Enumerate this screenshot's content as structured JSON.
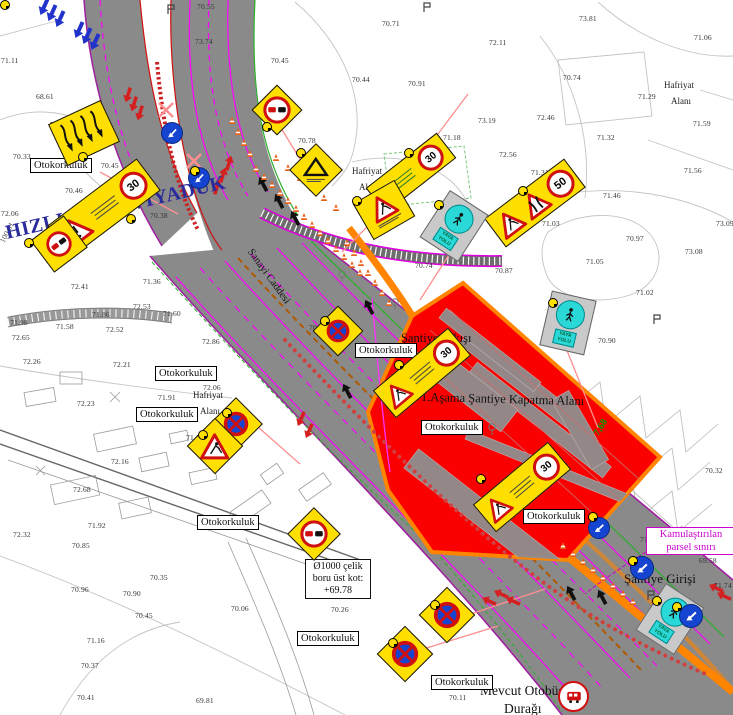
{
  "labels": {
    "hizli_tren": "HIZLI TREN VİYADÜK",
    "km": "100.01",
    "sanayi_caddesi": "Sanayi Caddesi",
    "otokorkuluk": "Otokorkuluk",
    "hafriyat": "Hafriyat",
    "alani": "Alanı",
    "santiye_cikisi": "Şantiye Çıkışı",
    "kapatma_alani": "1.Aşama Şantiye Kapatma Alanı",
    "santiye_girisi": "Şantiye Girişi",
    "kamulastirilan_l1": "Kamulaştırılan",
    "kamulastirilan_l2": "parsel sınırı",
    "mevcut_otobus_l1": "Mevcut Otobüs",
    "mevcut_otobus_l2": "Durağı",
    "boru_l1": "Ø1000 çelik",
    "boru_l2": "boru üst kot:",
    "boru_l3": "+69.78",
    "kot_768": "7,68",
    "yaya_1": "YAYA",
    "yaya_2": "YOLU"
  },
  "speeds": {
    "s30": "30",
    "s50": "50"
  },
  "colors": {
    "closure_red": "#fa0000",
    "barrier_orange": "#ff8400",
    "sign_yellow": "#ffdf00",
    "lane_magenta": "#ff00ff",
    "title_blue": "#2b2b9b",
    "parcel_magenta": "#cc00cc",
    "road_gray": "#8a8a8a"
  },
  "otokorkuluk_positions": [
    {
      "x": 30,
      "y": 158
    },
    {
      "x": 155,
      "y": 366
    },
    {
      "x": 136,
      "y": 407
    },
    {
      "x": 355,
      "y": 343
    },
    {
      "x": 421,
      "y": 420
    },
    {
      "x": 523,
      "y": 509
    },
    {
      "x": 197,
      "y": 515
    },
    {
      "x": 297,
      "y": 631
    },
    {
      "x": 431,
      "y": 675
    }
  ],
  "hafriyat_positions": [
    {
      "x": 352,
      "y": 166
    },
    {
      "x": 664,
      "y": 80
    },
    {
      "x": 193,
      "y": 390
    }
  ],
  "elevations": [
    {
      "v": "70.55",
      "x": 197,
      "y": 2
    },
    {
      "v": "73.74",
      "x": 195,
      "y": 37
    },
    {
      "v": "71.11",
      "x": 1,
      "y": 56
    },
    {
      "v": "68.61",
      "x": 36,
      "y": 92
    },
    {
      "v": "70.31",
      "x": 50,
      "y": 120
    },
    {
      "v": "70.33",
      "x": 13,
      "y": 152
    },
    {
      "v": "70.45",
      "x": 101,
      "y": 161
    },
    {
      "v": "70.46",
      "x": 65,
      "y": 186
    },
    {
      "v": "70.71",
      "x": 382,
      "y": 19
    },
    {
      "v": "70.45",
      "x": 271,
      "y": 56
    },
    {
      "v": "70.44",
      "x": 352,
      "y": 75
    },
    {
      "v": "70.91",
      "x": 408,
      "y": 79
    },
    {
      "v": "72.11",
      "x": 489,
      "y": 38
    },
    {
      "v": "73.19",
      "x": 478,
      "y": 116
    },
    {
      "v": "71.18",
      "x": 443,
      "y": 133
    },
    {
      "v": "70.78",
      "x": 298,
      "y": 136
    },
    {
      "v": "73.81",
      "x": 579,
      "y": 14
    },
    {
      "v": "71.06",
      "x": 694,
      "y": 33
    },
    {
      "v": "70.74",
      "x": 563,
      "y": 73
    },
    {
      "v": "71.29",
      "x": 638,
      "y": 92
    },
    {
      "v": "72.46",
      "x": 537,
      "y": 113
    },
    {
      "v": "71.59",
      "x": 693,
      "y": 119
    },
    {
      "v": "71.32",
      "x": 597,
      "y": 133
    },
    {
      "v": "72.56",
      "x": 499,
      "y": 150
    },
    {
      "v": "71.31",
      "x": 531,
      "y": 168
    },
    {
      "v": "71.56",
      "x": 684,
      "y": 166
    },
    {
      "v": "71.46",
      "x": 603,
      "y": 191
    },
    {
      "v": "72.06",
      "x": 1,
      "y": 209
    },
    {
      "v": "70.38",
      "x": 150,
      "y": 211
    },
    {
      "v": "72.41",
      "x": 71,
      "y": 282
    },
    {
      "v": "71.36",
      "x": 143,
      "y": 277
    },
    {
      "v": "72.53",
      "x": 133,
      "y": 302
    },
    {
      "v": "71.86",
      "x": 92,
      "y": 310
    },
    {
      "v": "71.60",
      "x": 163,
      "y": 309
    },
    {
      "v": "71.98",
      "x": 10,
      "y": 318
    },
    {
      "v": "71.58",
      "x": 56,
      "y": 322
    },
    {
      "v": "72.52",
      "x": 106,
      "y": 325
    },
    {
      "v": "72.65",
      "x": 12,
      "y": 333
    },
    {
      "v": "72.86",
      "x": 202,
      "y": 337
    },
    {
      "v": "72.26",
      "x": 23,
      "y": 357
    },
    {
      "v": "70.74",
      "x": 415,
      "y": 261
    },
    {
      "v": "70.99",
      "x": 309,
      "y": 323
    },
    {
      "v": "71.03",
      "x": 542,
      "y": 219
    },
    {
      "v": "73.09",
      "x": 716,
      "y": 219
    },
    {
      "v": "70.97",
      "x": 626,
      "y": 234
    },
    {
      "v": "73.08",
      "x": 685,
      "y": 247
    },
    {
      "v": "71.05",
      "x": 586,
      "y": 257
    },
    {
      "v": "70.87",
      "x": 495,
      "y": 266
    },
    {
      "v": "71.02",
      "x": 636,
      "y": 288
    },
    {
      "v": "70.90",
      "x": 598,
      "y": 336
    },
    {
      "v": "72.21",
      "x": 113,
      "y": 360
    },
    {
      "v": "72.06",
      "x": 203,
      "y": 383
    },
    {
      "v": "71.91",
      "x": 158,
      "y": 393
    },
    {
      "v": "72.23",
      "x": 77,
      "y": 399
    },
    {
      "v": "71.86",
      "x": 186,
      "y": 433
    },
    {
      "v": "72.16",
      "x": 111,
      "y": 457
    },
    {
      "v": "72.68",
      "x": 73,
      "y": 485
    },
    {
      "v": "71.92",
      "x": 88,
      "y": 521
    },
    {
      "v": "72.32",
      "x": 13,
      "y": 530
    },
    {
      "v": "70.85",
      "x": 72,
      "y": 541
    },
    {
      "v": "70.96",
      "x": 71,
      "y": 585
    },
    {
      "v": "70.90",
      "x": 123,
      "y": 589
    },
    {
      "v": "70.35",
      "x": 150,
      "y": 573
    },
    {
      "v": "70.45",
      "x": 135,
      "y": 611
    },
    {
      "v": "71.16",
      "x": 87,
      "y": 636
    },
    {
      "v": "70.37",
      "x": 81,
      "y": 661
    },
    {
      "v": "70.41",
      "x": 77,
      "y": 693
    },
    {
      "v": "69.81",
      "x": 196,
      "y": 696
    },
    {
      "v": "70.06",
      "x": 231,
      "y": 604
    },
    {
      "v": "70.11",
      "x": 449,
      "y": 693
    },
    {
      "v": "70.32",
      "x": 705,
      "y": 466
    },
    {
      "v": "71.17",
      "x": 640,
      "y": 535
    },
    {
      "v": "71.74",
      "x": 714,
      "y": 581
    },
    {
      "v": "69.58",
      "x": 699,
      "y": 556
    },
    {
      "v": "70.26",
      "x": 331,
      "y": 605
    }
  ]
}
